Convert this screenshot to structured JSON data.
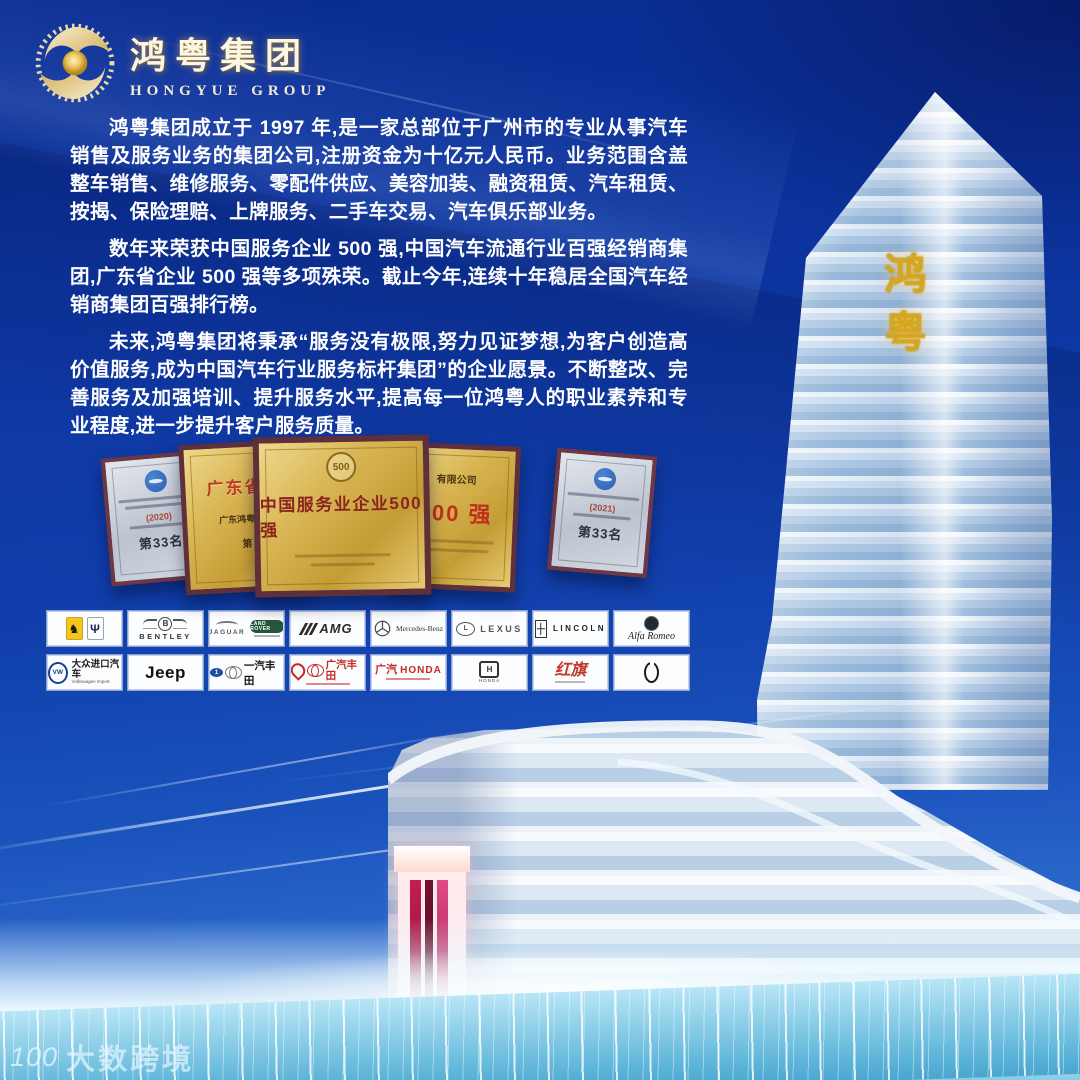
{
  "brand": {
    "logo_cn": "鸿粤集团",
    "logo_en": "HONGYUE GROUP"
  },
  "intro": {
    "paragraphs": [
      "鸿粤集团成立于 1997 年,是一家总部位于广州市的专业从事汽车销售及服务业务的集团公司,注册资金为十亿元人民币。业务范围含盖整车销售、维修服务、零配件供应、美容加装、融资租赁、汽车租赁、按揭、保险理赔、上牌服务、二手车交易、汽车俱乐部业务。",
      "数年来荣获中国服务企业 500 强,中国汽车流通行业百强经销商集团,广东省企业 500 强等多项殊荣。截止今年,连续十年稳居全国汽车经销商集团百强排行榜。",
      "未来,鸿粤集团将秉承“服务没有极限,努力见证梦想,为客户创造高价值服务,成为中国汽车行业服务标杆集团”的企业愿景。不断整改、完善服务及加强培训、提升服务水平,提高每一位鸿粤人的职业素养和专业程度,进一步提升客户服务质量。"
    ]
  },
  "awards": {
    "plaques": [
      {
        "style": "silver",
        "year": "(2020)",
        "rank": "第33名"
      },
      {
        "style": "gold",
        "title_fragment": "广东省百",
        "sub_fragment": "广东鸿粤汽车",
        "rank_fragment": "第"
      },
      {
        "style": "gold-center",
        "badge": "500",
        "title": "中国服务业企业500强"
      },
      {
        "style": "gold",
        "top_fragment": "有限公司",
        "big": "500 强"
      },
      {
        "style": "silver",
        "year": "(2021)",
        "rank": "第33名"
      }
    ]
  },
  "dealers": {
    "row1": [
      {
        "name": "Ferrari / Maserati",
        "ferrari_glyph": "♞",
        "maserati_glyph": "Ψ"
      },
      {
        "name": "Bentley",
        "badge": "B",
        "label": "BENTLEY"
      },
      {
        "name": "Jaguar / Land Rover",
        "label_a": "JAGUAR",
        "label_b": "LAND ROVER"
      },
      {
        "name": "Mercedes-AMG",
        "label": "AMG"
      },
      {
        "name": "Mercedes-Benz",
        "label": "Mercedes-Benz"
      },
      {
        "name": "Lexus",
        "badge": "L",
        "label": "LEXUS"
      },
      {
        "name": "Lincoln",
        "label": "LINCOLN"
      },
      {
        "name": "Alfa Romeo",
        "label": "Alfa Romeo"
      }
    ],
    "row2": [
      {
        "name": "Volkswagen Import",
        "badge": "VW",
        "label_cn": "大众进口汽车",
        "label_en": "Volkswagen Import"
      },
      {
        "name": "Jeep",
        "label": "Jeep"
      },
      {
        "name": "FAW Toyota",
        "badge": "1",
        "label_cn": "一汽丰田"
      },
      {
        "name": "GAC Toyota",
        "label_cn": "广汽丰田"
      },
      {
        "name": "GAC Honda",
        "label_cn": "广汽",
        "label_en": "HONDA"
      },
      {
        "name": "Honda",
        "badge": "H",
        "label": "HONDA"
      },
      {
        "name": "Hongqi",
        "label_cn": "红旗"
      },
      {
        "name": "Vertical Oval Emblem"
      }
    ]
  },
  "tower": {
    "sign": "鸿粤"
  },
  "watermark": {
    "logo": "100",
    "text": "大数跨境"
  }
}
